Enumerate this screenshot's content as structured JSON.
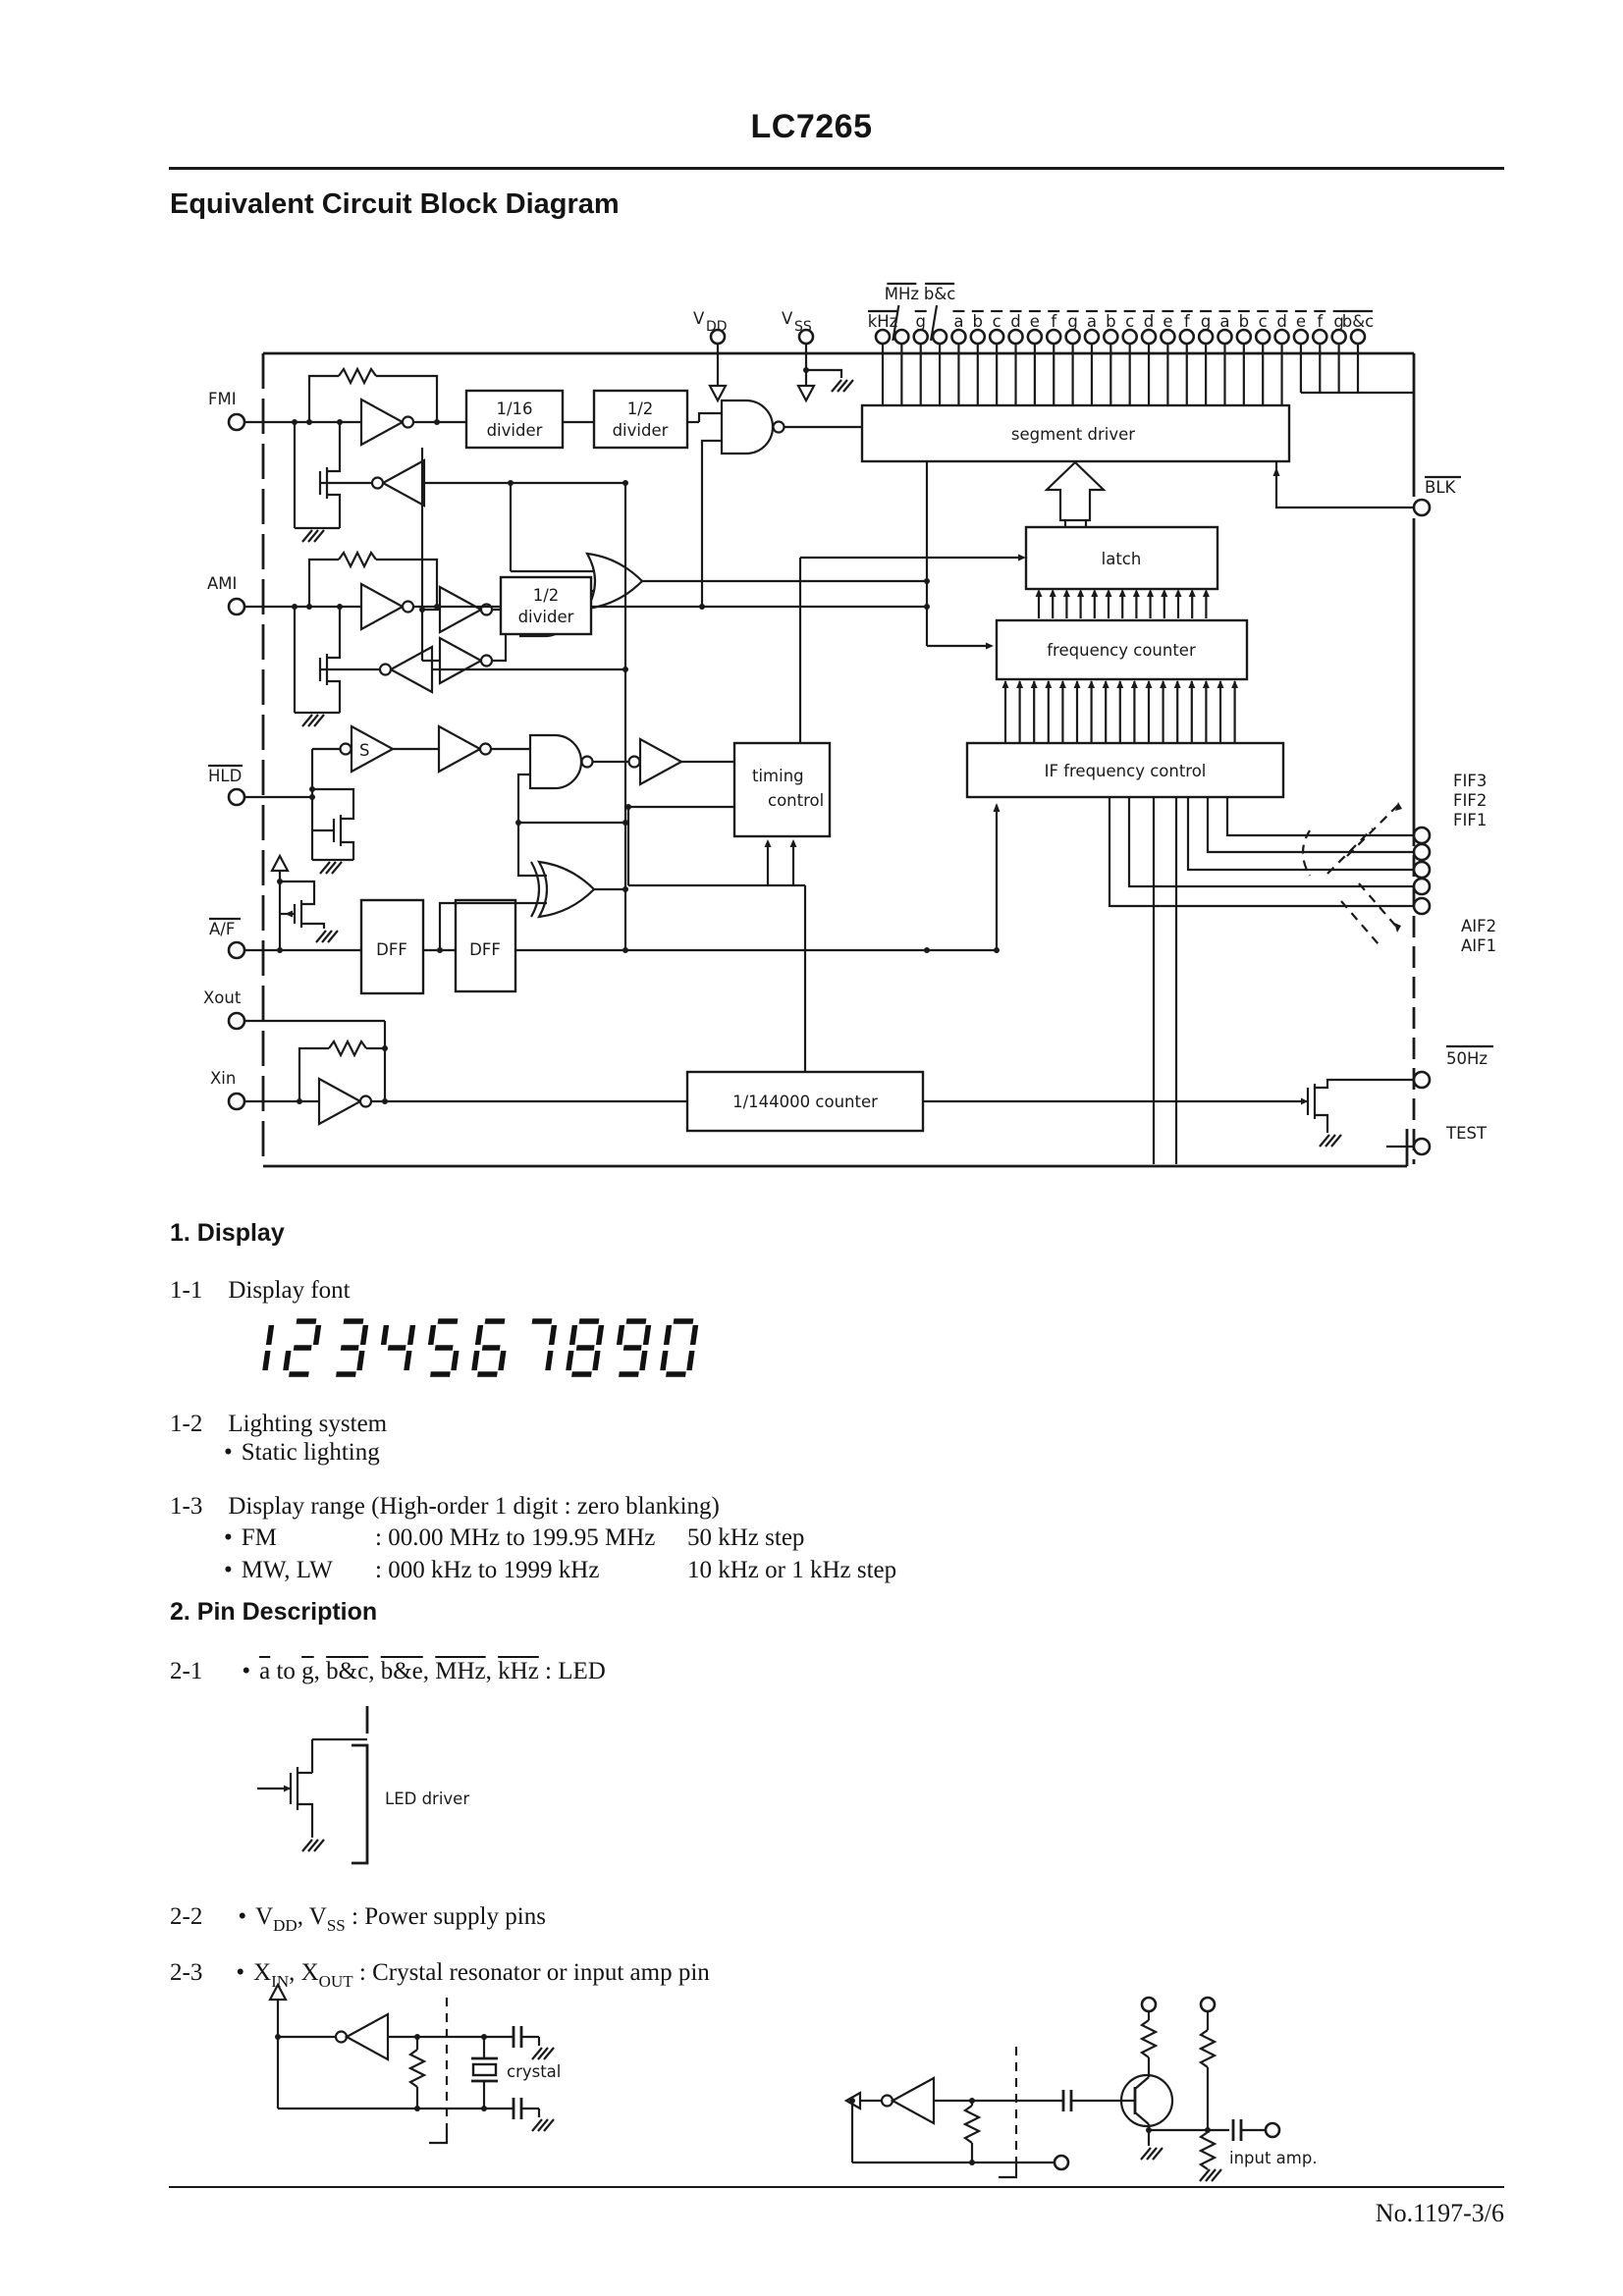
{
  "page": {
    "brand": "LC7265",
    "title": "Equivalent Circuit Block Diagram",
    "footer": "No.1197-3/6"
  },
  "diagram": {
    "power": {
      "v": "V",
      "dd": "DD",
      "ss": "SS"
    },
    "top_pins": [
      {
        "label": "kHz"
      },
      {
        "label": "MHz",
        "raised": true
      },
      {
        "label": "g"
      },
      {
        "label": "b&c",
        "raised": true
      },
      {
        "label": "a"
      },
      {
        "label": "b"
      },
      {
        "label": "c"
      },
      {
        "label": "d"
      },
      {
        "label": "e"
      },
      {
        "label": "f"
      },
      {
        "label": "g"
      },
      {
        "label": "a"
      },
      {
        "label": "b"
      },
      {
        "label": "c"
      },
      {
        "label": "d"
      },
      {
        "label": "e"
      },
      {
        "label": "f"
      },
      {
        "label": "g"
      },
      {
        "label": "a"
      },
      {
        "label": "b"
      },
      {
        "label": "c"
      },
      {
        "label": "d"
      },
      {
        "label": "e"
      },
      {
        "label": "f"
      },
      {
        "label": "g"
      },
      {
        "label": "b&c"
      }
    ],
    "left_pins": [
      {
        "label": "FMI"
      },
      {
        "label": "AMI"
      },
      {
        "label": "HLD",
        "overline": true
      },
      {
        "label": "A/F",
        "overline": true
      },
      {
        "label": "Xout"
      },
      {
        "label": "Xin"
      }
    ],
    "right_pins": [
      {
        "label": "BLK",
        "overline": true
      },
      {
        "label": "FIF3"
      },
      {
        "label": "FIF2"
      },
      {
        "label": "FIF1"
      },
      {
        "label": "AIF2"
      },
      {
        "label": "AIF1"
      },
      {
        "label": "50Hz",
        "overline": true
      },
      {
        "label": "TEST"
      }
    ],
    "blocks": {
      "div16_1": "1/16",
      "div16_2": "divider",
      "div2a_1": "1/2",
      "div2a_2": "divider",
      "div2b_1": "1/2",
      "div2b_2": "divider",
      "segment": "segment driver",
      "latch": "latch",
      "freq": "frequency counter",
      "ifctl": "IF frequency control",
      "timing_1": "timing",
      "timing_2": "control",
      "counter": "1/144000 counter",
      "dff": "DFF",
      "s": "S"
    },
    "figs": {
      "led": "LED driver",
      "crystal": "crystal",
      "amp": "input amp."
    }
  },
  "sections": {
    "s1": {
      "heading": "1. Display",
      "s11": {
        "num": "1-1",
        "text": "Display font"
      },
      "display_digits": "1234567890",
      "s12": {
        "num": "1-2",
        "text": "Lighting system",
        "bullet": "•",
        "item": "Static lighting"
      },
      "s13": {
        "num": "1-3",
        "text": "Display range (High-order 1 digit : zero blanking)",
        "rows": [
          {
            "bullet": "•",
            "label": "FM",
            "range": ": 00.00 MHz to 199.95 MHz",
            "step": "50 kHz step"
          },
          {
            "bullet": "•",
            "label": "MW, LW",
            "range": ": 000 kHz to 1999 kHz",
            "step": "10 kHz or 1 kHz step"
          }
        ]
      }
    },
    "s2": {
      "heading": "2. Pin Description",
      "s21": {
        "num": "2-1",
        "bullet": "•",
        "a": "a",
        "to": " to ",
        "g": "g",
        "c1": ", ",
        "bc": "b&c",
        "c2": ", ",
        "be": "b&e",
        "c3": ", ",
        "mhz": "MHz",
        "c4": ", ",
        "khz": "kHz",
        "tail": " : LED"
      },
      "s22": {
        "num": "2-2",
        "bullet": "•",
        "v": "V",
        "dd": "DD",
        "mid": ", V",
        "ss": "SS",
        "tail": " : Power supply pins"
      },
      "s23": {
        "num": "2-3",
        "bullet": "•",
        "x": "X",
        "in": "IN",
        "mid": ", X",
        "out": "OUT",
        "tail": " : Crystal resonator or input amp pin"
      }
    }
  }
}
